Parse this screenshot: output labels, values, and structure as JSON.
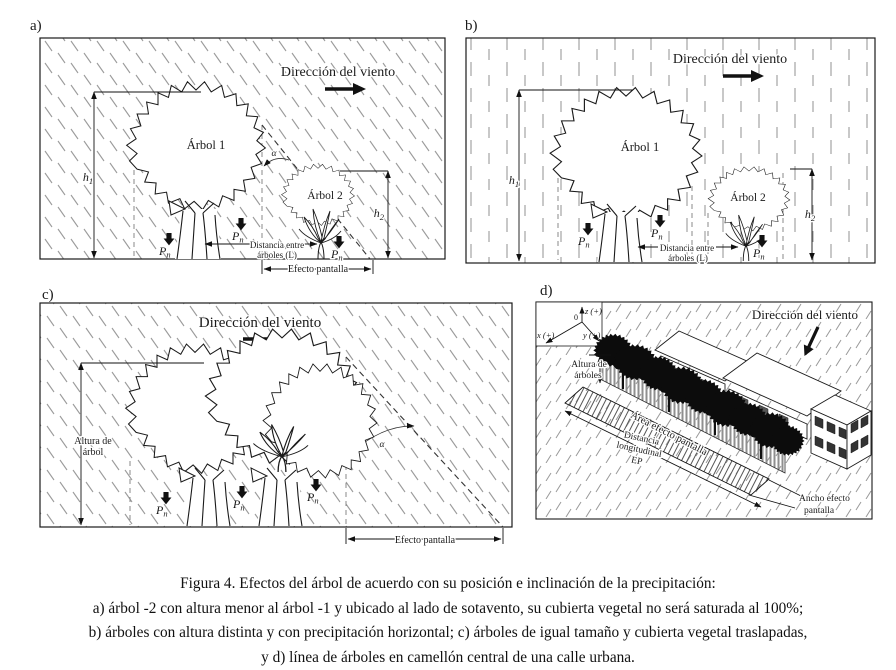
{
  "panels": {
    "a": {
      "tag": "a)",
      "wind": "Dirección del viento",
      "tree1": "Árbol 1",
      "tree2": "Árbol 2",
      "dist_line1": "Distancia entre",
      "dist_line2": "árboles (L)",
      "screen": "Efecto pantalla"
    },
    "b": {
      "tag": "b)",
      "wind": "Dirección del viento",
      "tree1": "Árbol 1",
      "tree2": "Árbol 2",
      "dist_line1": "Distancia entre",
      "dist_line2": "árboles (L)"
    },
    "c": {
      "tag": "c)",
      "wind": "Dirección del viento",
      "height_line1": "Altura de",
      "height_line2": "árbol",
      "screen": "Efecto pantalla"
    },
    "d": {
      "tag": "d)",
      "wind": "Dirección del viento",
      "axis_z": "z (+)",
      "axis_x": "x (+)",
      "axis_y": "y (+)",
      "axis_origin": "0",
      "height_line1": "Altura de",
      "height_line2": "árboles",
      "area": "Área efecto pantalla",
      "dist_line1": "Distancia",
      "dist_line2": "longitudinal",
      "dist_line3": "EP",
      "width_line1": "Ancho efecto",
      "width_line2": "pantalla"
    }
  },
  "symbols": {
    "P": "P",
    "n": "n",
    "h": "h",
    "sub1": "1",
    "sub2": "2",
    "alpha": "α"
  },
  "caption": {
    "line1": "Figura 4. Efectos del árbol de acuerdo con su posición e inclinación de la precipitación:",
    "line2": "a) árbol -2 con altura menor al árbol -1 y ubicado al lado de sotavento, su cubierta vegetal no será saturada al 100%;",
    "line3": "b) árboles con altura distinta y con precipitación horizontal; c) árboles de igual tamaño y cubierta vegetal traslapadas,",
    "line4": "y d) línea de árboles en camellón central de una calle urbana."
  }
}
